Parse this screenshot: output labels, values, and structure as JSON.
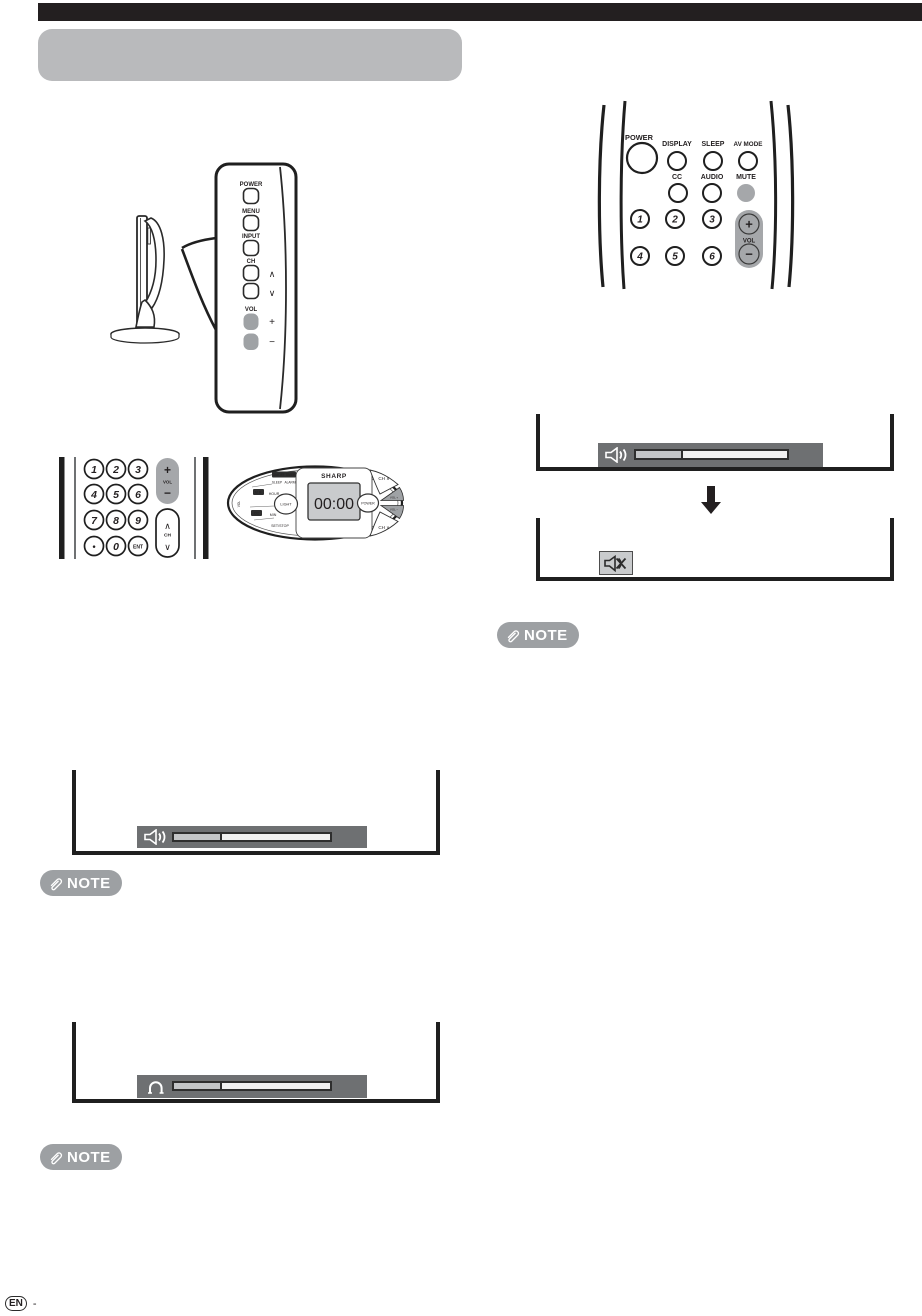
{
  "page": {
    "note_label": "NOTE",
    "footer_lang": "EN",
    "footer_dash": "-"
  },
  "tv_side_panel": {
    "power": "POWER",
    "menu": "MENU",
    "input": "INPUT",
    "ch": "CH",
    "ch_up": "∧",
    "ch_down": "∨",
    "vol": "VOL",
    "plus": "+",
    "minus": "−"
  },
  "keypad_remote": {
    "digits": [
      "1",
      "2",
      "3",
      "4",
      "5",
      "6",
      "7",
      "8",
      "9"
    ],
    "dot": "•",
    "zero": "0",
    "enter": "ENT",
    "vol": "VOL",
    "plus": "+",
    "minus": "−",
    "ch": "CH",
    "ch_up": "∧",
    "ch_down": "∨"
  },
  "oval_remote": {
    "brand": "SHARP",
    "display_time": "00:00",
    "onoff_timer": "ON/OFF TIMER",
    "sleep": "SLEEP",
    "alarm": "ALARM",
    "mb": "M.B.",
    "hour": "HOUR",
    "cc": "CC",
    "min": "MIN",
    "light": "LIGHT",
    "set_stop": "SET/STOP",
    "side_vol": "VOL",
    "ch_up": "CH ∧",
    "ch_down": "CH ∨",
    "power": "POWER",
    "vol_plus": "VOL +",
    "vol_minus": "VOL −"
  },
  "main_remote": {
    "power": "POWER",
    "display": "DISPLAY",
    "sleep": "SLEEP",
    "av_mode": "AV MODE",
    "cc": "CC",
    "audio": "AUDIO",
    "mute": "MUTE",
    "digits": [
      "1",
      "2",
      "3",
      "4",
      "5",
      "6"
    ],
    "vol": "VOL",
    "plus": "+",
    "minus": "−"
  },
  "osd": {
    "volume_fill_percent": 31
  }
}
